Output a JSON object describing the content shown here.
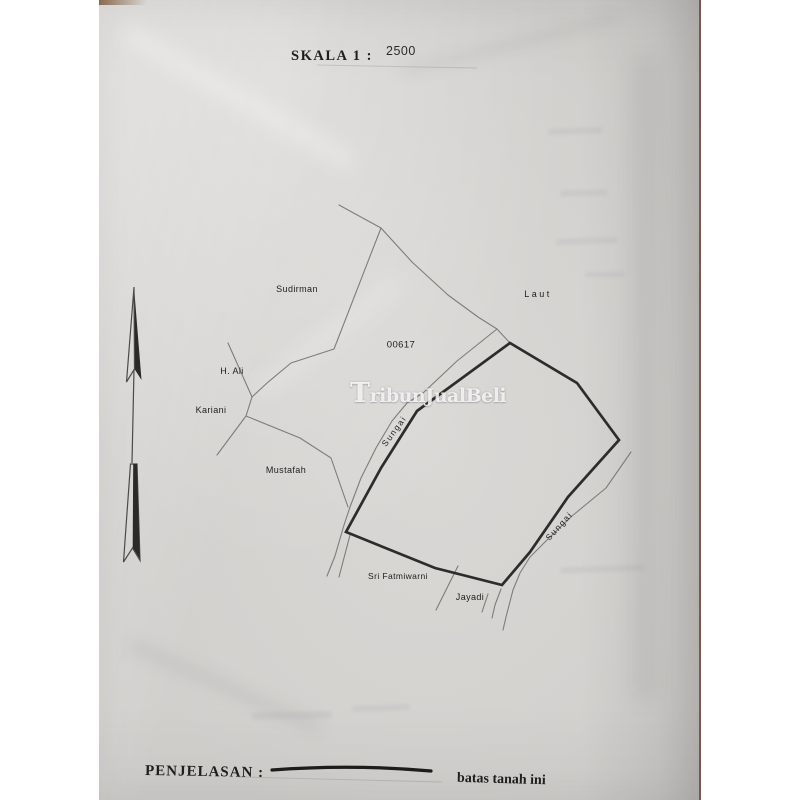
{
  "header": {
    "scale_label": "SKALA 1 :",
    "scale_value": "2500"
  },
  "legend": {
    "label": "PENJELASAN :",
    "value": "batas tanah ini"
  },
  "watermark": {
    "initial": "T",
    "rest": "ribunJualBeli"
  },
  "map": {
    "parcel_number": "00617",
    "labels": {
      "sudirman": "Sudirman",
      "laut": "Laut",
      "h_ali": "H. Ali",
      "kariani": "Kariani",
      "mustafah": "Mustafah",
      "sri_fatmiwarni": "Sri Fatmiwarni",
      "jayadi": "Jayadi",
      "sungai_left": "Sungai",
      "sungai_right": "Sungai"
    }
  },
  "icons": {
    "north_arrow": "↑"
  },
  "colors": {
    "paper": "#d6d4d1",
    "backdrop": "#ffffff",
    "ink": "#2a2a28",
    "line_thin": "#7f7d79",
    "line_thick": "#2e2c2a",
    "text": "#1f1e1c",
    "watermark_fill": "rgba(255,255,255,0.82)",
    "edge_line": "#7e564b",
    "sliver": "#8a6a4f"
  }
}
